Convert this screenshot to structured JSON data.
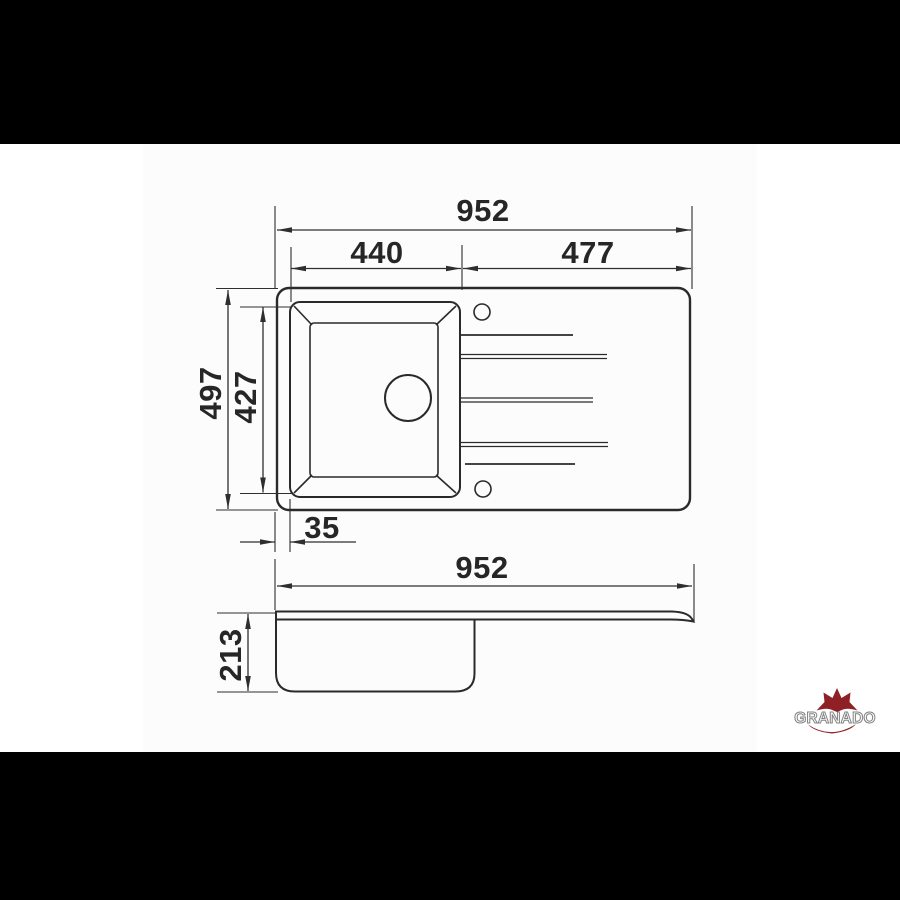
{
  "scene": {
    "description": "Technical dimension drawing of a kitchen sink with drainboard, top view and side view",
    "background_bars_color": "#000000",
    "canvas_color": "#ffffff",
    "line_color": "#2a2a2a",
    "text_color": "#262626"
  },
  "top_view": {
    "dims": {
      "total_width": "952",
      "bowl_width": "440",
      "drainer_width": "477",
      "total_depth": "497",
      "bowl_depth": "427",
      "rim_offset": "35"
    }
  },
  "side_view": {
    "dims": {
      "total_width": "952",
      "bowl_height": "213"
    }
  },
  "logo": {
    "brand": "GRANADO",
    "red": "#8e2026",
    "gray": "#838383"
  }
}
